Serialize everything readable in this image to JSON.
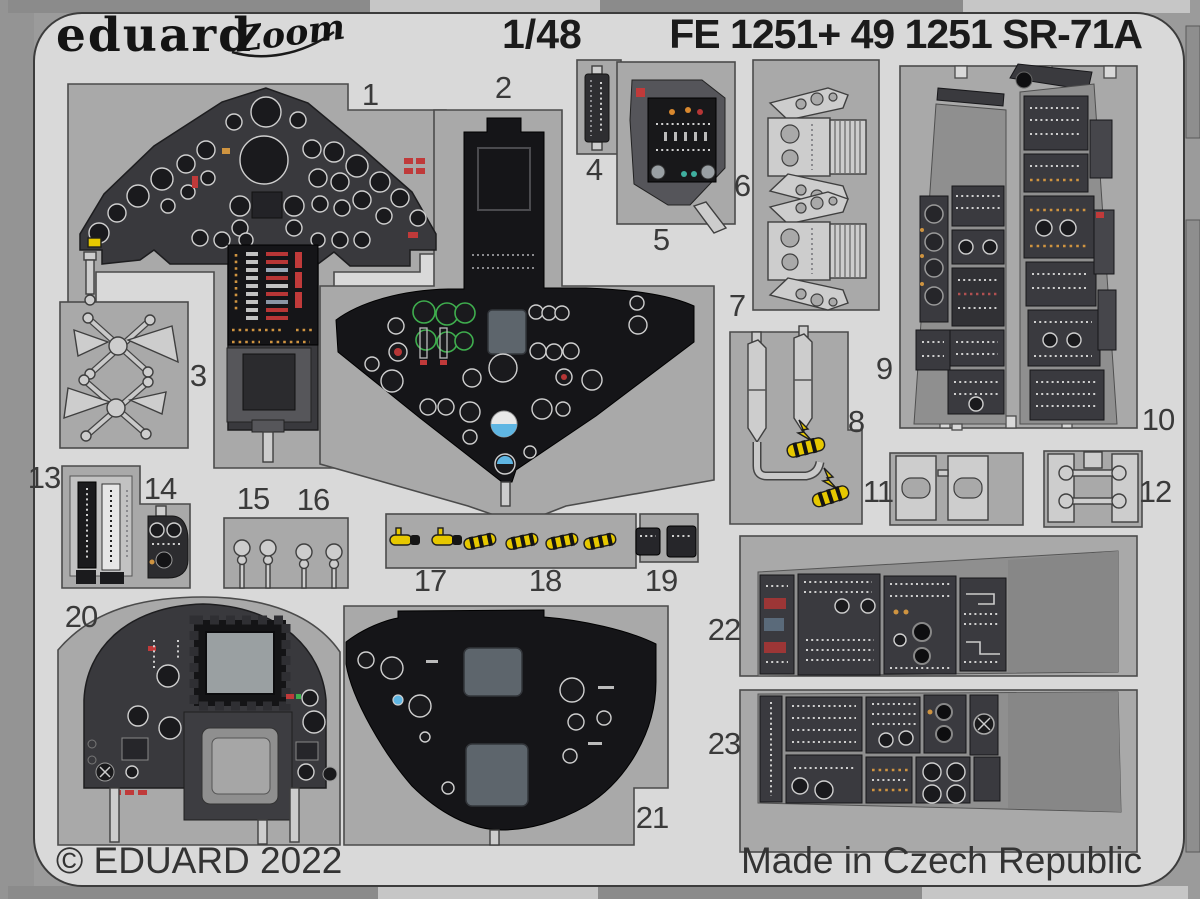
{
  "header": {
    "brand": "eduard",
    "series_logo": "Zoom",
    "scale": "1/48",
    "title": "FE 1251+ 49 1251 SR-71A"
  },
  "footer": {
    "copyright": "© EDUARD 2022",
    "made_in": "Made in Czech Republic"
  },
  "part_labels": [
    "1",
    "2",
    "3",
    "4",
    "5",
    "6",
    "7",
    "8",
    "9",
    "10",
    "11",
    "12",
    "13",
    "14",
    "15",
    "16",
    "17",
    "18",
    "19",
    "20",
    "21",
    "22",
    "23"
  ],
  "colors": {
    "outer": "#9b9b9b",
    "sheet": "#d9d9d9",
    "cutout": "#a9a9a9",
    "metal": "#cdcdcd",
    "panel_black": "#151518",
    "panel_dark": "#39393d",
    "yellow": "#e6c800",
    "red": "#c03a3a",
    "blue": "#5fb6e3",
    "green": "#3fae4e",
    "screen": "#5d656c",
    "ink": "#3a3a3a"
  }
}
